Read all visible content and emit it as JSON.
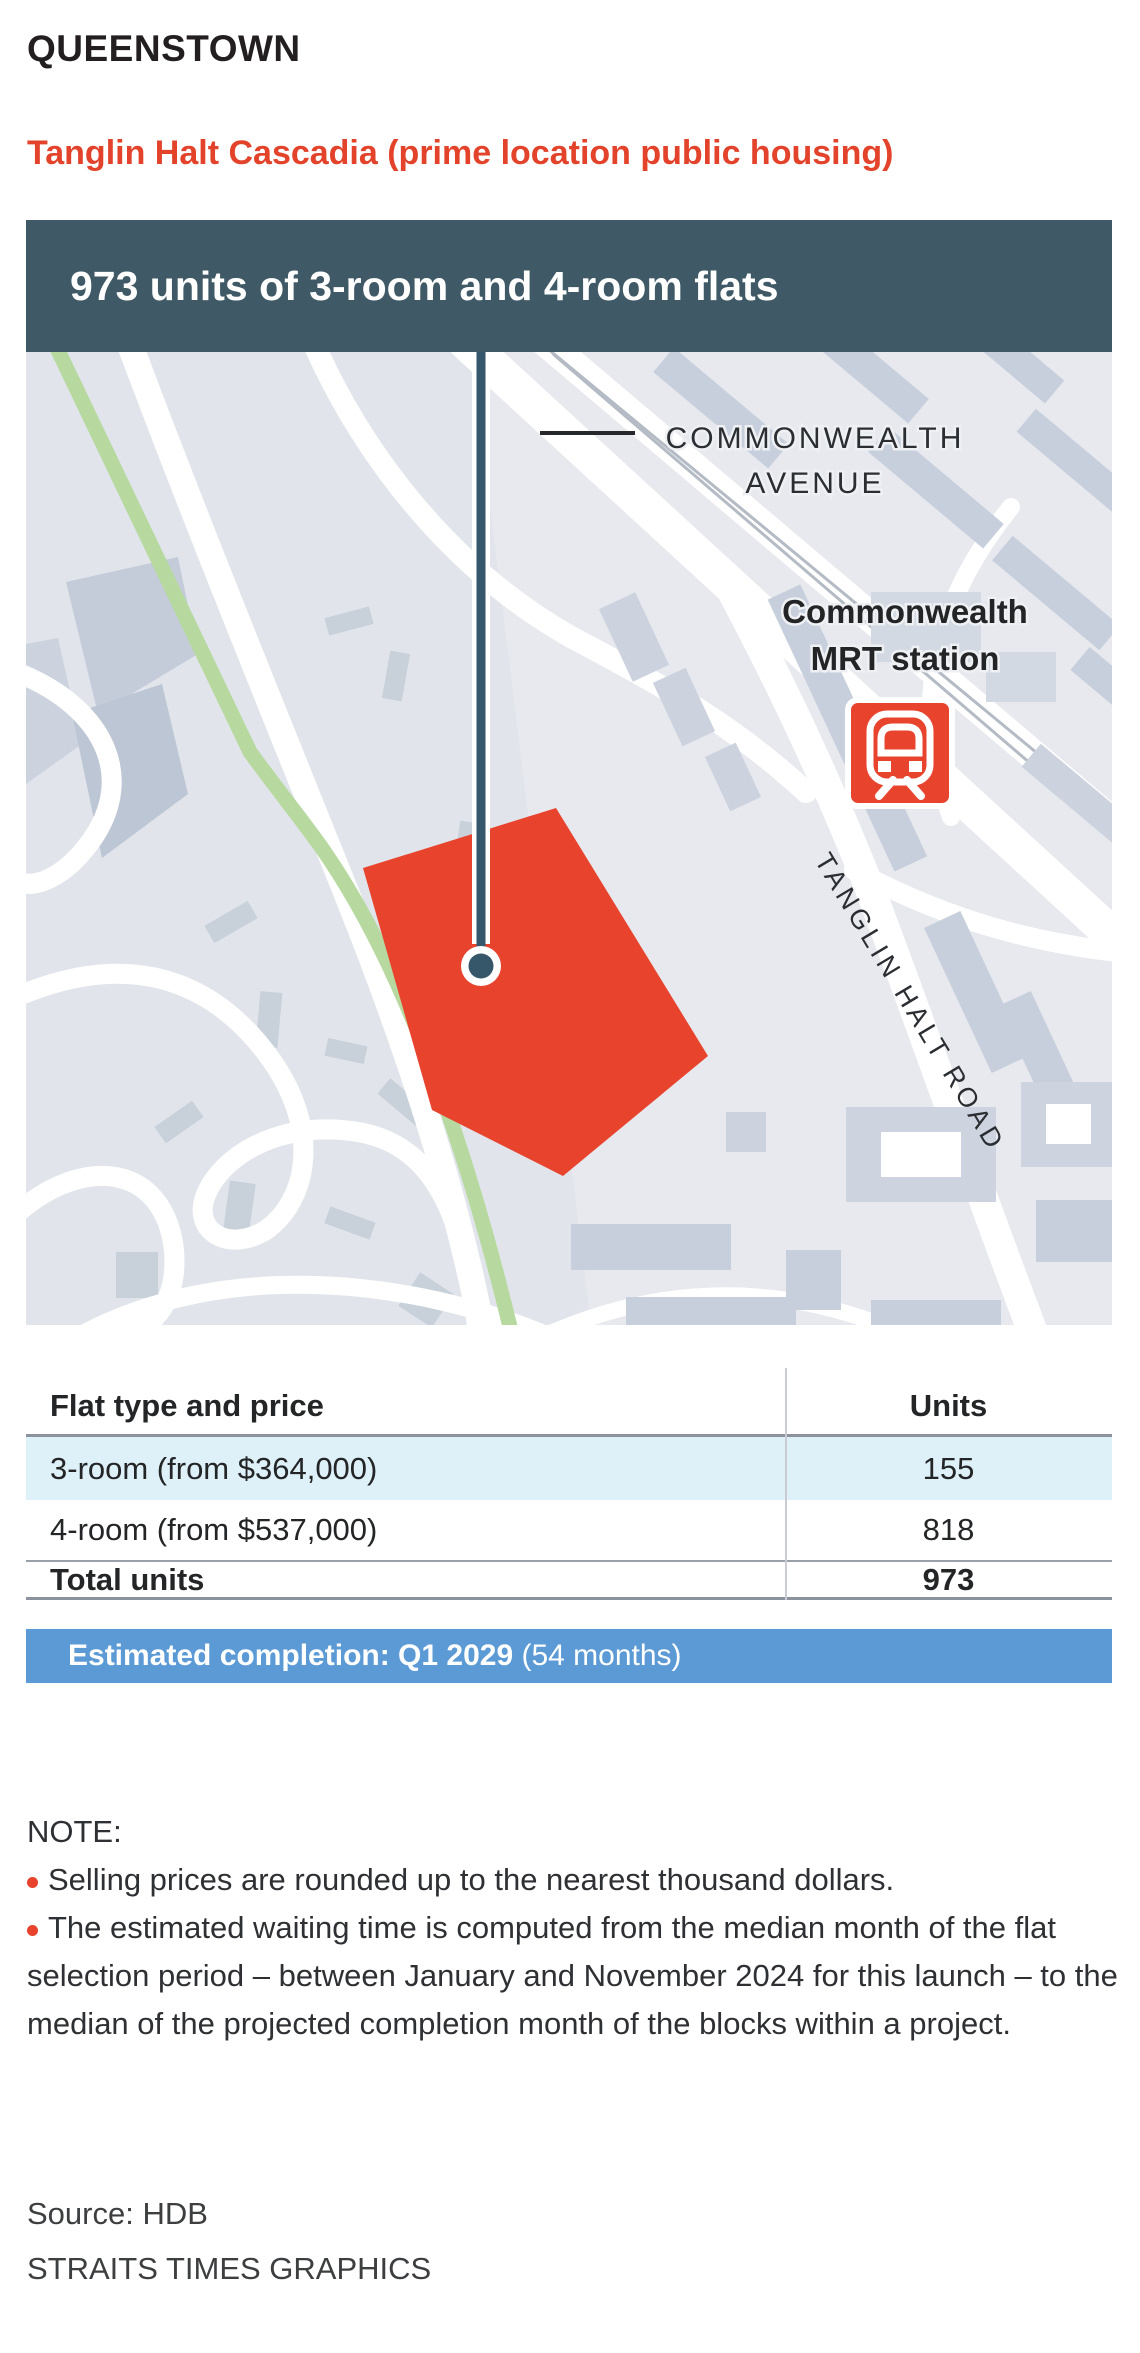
{
  "page": {
    "region": "QUEENSTOWN",
    "title": "Tanglin Halt Cascadia (prime location public housing)",
    "banner": "973 units of 3-room and 4-room flats"
  },
  "map": {
    "avenue_label_line1": "COMMONWEALTH",
    "avenue_label_line2": "AVENUE",
    "mrt_label_line1": "Commonwealth",
    "mrt_label_line2": "MRT station",
    "road_label": "TANGLIN HALT ROAD"
  },
  "chart_data": {
    "type": "table",
    "title": "Tanglin Halt Cascadia (prime location public housing)",
    "columns": [
      "Flat type and price",
      "Units"
    ],
    "rows": [
      [
        "3-room (from $364,000)",
        155
      ],
      [
        "4-room (from $537,000)",
        818
      ]
    ],
    "total": [
      "Total units",
      973
    ],
    "completion": "Estimated completion: Q1 2029 (54 months)"
  },
  "table": {
    "col1_header": "Flat type and price",
    "col2_header": "Units",
    "rows": [
      {
        "label": "3-room (from $364,000)",
        "units": "155"
      },
      {
        "label": "4-room (from $537,000)",
        "units": "818"
      }
    ],
    "total_label": "Total units",
    "total_units": "973"
  },
  "completion": {
    "bold": "Estimated completion: Q1 2029",
    "regular": " (54 months)"
  },
  "notes": {
    "heading": "NOTE:",
    "items": [
      "Selling prices are rounded up to the nearest thousand dollars.",
      "The estimated waiting time is computed from the median month of the flat selection period – between January and November 2024 for this launch – to the median of the projected completion month of the blocks within a project."
    ]
  },
  "footer": {
    "source": "Source: HDB",
    "credit": "STRAITS TIMES GRAPHICS"
  },
  "colors": {
    "teal": "#3f5966",
    "accent-red": "#e8432d",
    "title-red": "#e2432a",
    "banner-blue": "#5b9ad5",
    "row-blue": "#def0f8",
    "map-bg": "#e7e9ee",
    "building": "#c7cfdc",
    "green": "#b7d9a0"
  }
}
